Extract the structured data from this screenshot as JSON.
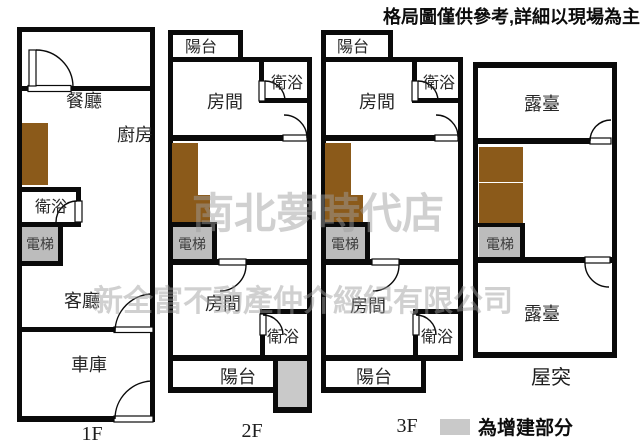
{
  "disclaimer": "格局圖僅供參考,詳細以現場為主",
  "legend": {
    "added_label": "為增建部分"
  },
  "watermark": {
    "line1": "南北夢時代店",
    "line2": "新全富不動產仲介經紀有限公司"
  },
  "floors": {
    "f1": {
      "label": "1F",
      "dining": "餐廳",
      "kitchen": "廚房",
      "bath": "衛浴",
      "elevator": "電梯",
      "living": "客廳",
      "garage": "車庫"
    },
    "f2": {
      "label": "2F",
      "balcony_top": "陽台",
      "room_top": "房間",
      "bath_top": "衛浴",
      "elevator": "電梯",
      "room_bottom": "房間",
      "bath_bottom": "衛浴",
      "balcony_bottom": "陽台"
    },
    "f3": {
      "label": "3F",
      "balcony_top": "陽台",
      "room_top": "房間",
      "bath_top": "衛浴",
      "elevator": "電梯",
      "room_bottom": "房間",
      "bath_bottom": "衛浴",
      "balcony_bottom": "陽台"
    },
    "roof": {
      "label": "屋突",
      "terrace_top": "露臺",
      "elevator": "電梯",
      "terrace_bottom": "露臺"
    }
  },
  "colors": {
    "wall": "#0a0a0a",
    "cabinet": "#8b5a1a",
    "elevator_fill": "#bcbcbc",
    "added_fill": "#c9c9c9",
    "watermark": "#9e9e9e"
  }
}
